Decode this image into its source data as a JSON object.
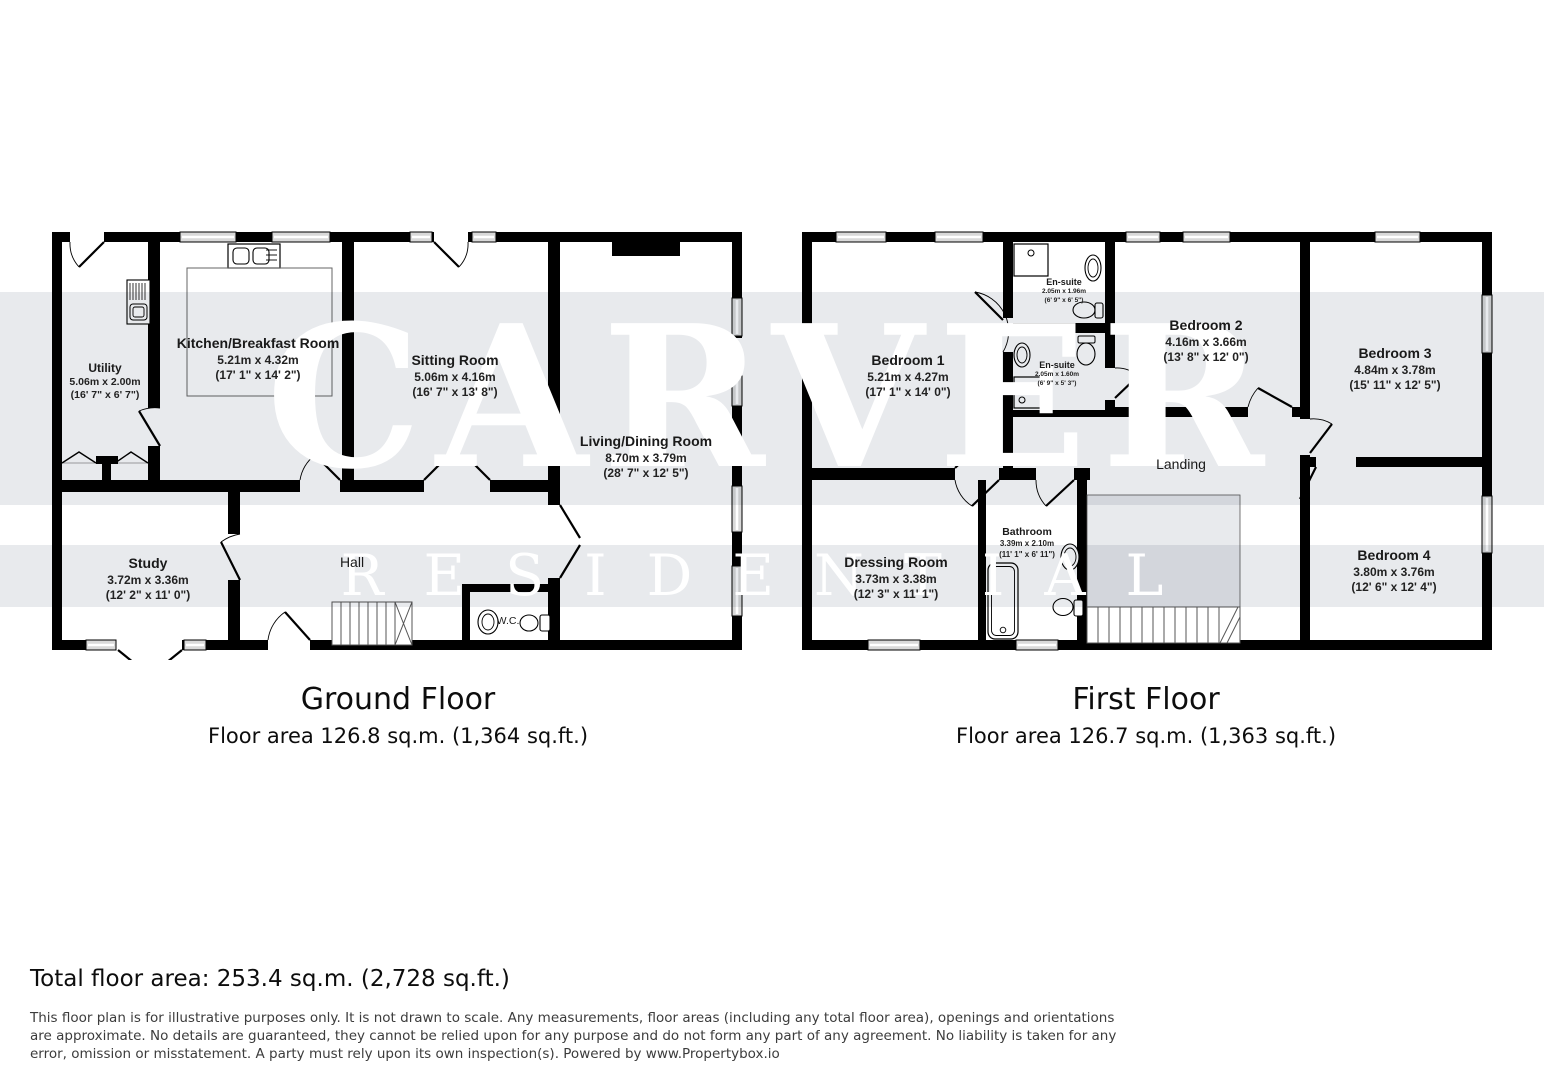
{
  "watermark": {
    "line1": "CARVER",
    "line2": "RESIDENTIAL"
  },
  "floors": [
    {
      "title": "Ground Floor",
      "area_label": "Floor area 126.8 sq.m. (1,364 sq.ft.)",
      "rooms": [
        {
          "name": "Utility",
          "metric": "5.06m x 2.00m",
          "imperial": "(16' 7\" x 6' 7\")"
        },
        {
          "name": "Kitchen/Breakfast Room",
          "metric": "5.21m x 4.32m",
          "imperial": "(17' 1\" x 14' 2\")"
        },
        {
          "name": "Sitting Room",
          "metric": "5.06m x 4.16m",
          "imperial": "(16' 7\" x 13' 8\")"
        },
        {
          "name": "Living/Dining Room",
          "metric": "8.70m x 3.79m",
          "imperial": "(28' 7\" x 12' 5\")"
        },
        {
          "name": "Study",
          "metric": "3.72m x 3.36m",
          "imperial": "(12' 2\" x 11' 0\")"
        },
        {
          "name": "Hall"
        },
        {
          "name": "W.C."
        }
      ]
    },
    {
      "title": "First Floor",
      "area_label": "Floor area 126.7 sq.m. (1,363 sq.ft.)",
      "rooms": [
        {
          "name": "Bedroom 1",
          "metric": "5.21m x 4.27m",
          "imperial": "(17' 1\" x 14' 0\")"
        },
        {
          "name": "En-suite",
          "metric": "2.05m x 1.96m",
          "imperial": "(6' 9\" x 6' 5\")"
        },
        {
          "name": "En-suite",
          "metric": "2.05m x 1.60m",
          "imperial": "(6' 9\" x 5' 3\")"
        },
        {
          "name": "Bedroom 2",
          "metric": "4.16m x 3.66m",
          "imperial": "(13' 8\" x 12' 0\")"
        },
        {
          "name": "Bedroom 3",
          "metric": "4.84m x 3.78m",
          "imperial": "(15' 11\" x 12' 5\")"
        },
        {
          "name": "Landing"
        },
        {
          "name": "Dressing Room",
          "metric": "3.73m x 3.38m",
          "imperial": "(12' 3\" x 11' 1\")"
        },
        {
          "name": "Bathroom",
          "metric": "3.39m x 2.10m",
          "imperial": "(11' 1\" x 6' 11\")"
        },
        {
          "name": "Bedroom 4",
          "metric": "3.80m x 3.76m",
          "imperial": "(12' 6\" x 12' 4\")"
        }
      ]
    }
  ],
  "footer": {
    "total": "Total floor area: 253.4 sq.m. (2,728 sq.ft.)",
    "disclaimer": "This floor plan is for illustrative purposes only. It is not drawn to scale. Any measurements, floor areas (including any total floor area), openings and orientations are approximate. No details are guaranteed, they cannot be relied upon for any purpose and do not form any part of any agreement. No liability is taken for any error, omission or misstatement. A party must rely upon its own inspection(s). Powered by www.Propertybox.io"
  }
}
